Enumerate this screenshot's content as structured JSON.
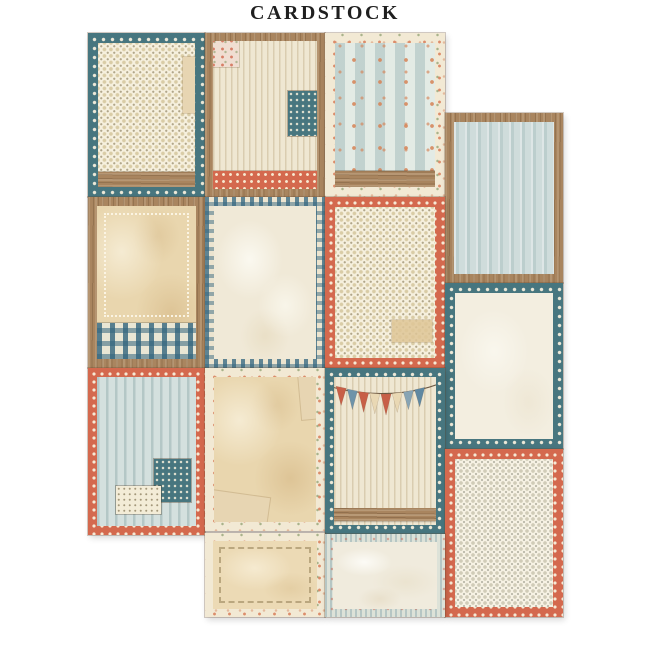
{
  "title": "CARDSTOCK",
  "palette": {
    "background": "#ffffff",
    "title_color": "#1f1f1f",
    "teal": "#47767f",
    "salmon": "#d4694e",
    "cream": "#f3ecd9",
    "tan_paper": "#e8d2a8",
    "wood": "#a9855f",
    "light_blue": "#d4e0de",
    "gingham_blue": "#3e7189"
  },
  "sheet": {
    "description": "Staggered collage of 14 vintage patchwork journaling cards on a cardstock sheet",
    "bunting": {
      "flag_colors": [
        "#c75f47",
        "#6e93a9",
        "#c75f47",
        "#e9d8b4",
        "#c75f47",
        "#e9d8b4",
        "#87a4b4",
        "#5f88a2"
      ],
      "string_color": "#6b5741"
    },
    "cards": [
      {
        "id": "card-1",
        "row": 1,
        "column": 1,
        "border": "teal-polka-dot",
        "center": "cream-micro-dots",
        "accents": [
          "torn-paper-edge",
          "wood-strip-bottom"
        ],
        "label": "Teal polka-dot card with dotted cream center and wood strip"
      },
      {
        "id": "card-2",
        "row": 1,
        "column": 2,
        "border": "wood-frame",
        "center": "cream-ticking-stripes",
        "accents": [
          "floral-patch-top-left",
          "teal-dot-patch-right",
          "coral-polka-strip-bottom"
        ],
        "label": "Wood framed striped card with fabric patches and coral dot band"
      },
      {
        "id": "card-3",
        "row": 1,
        "column": 3,
        "border": "cream-floral",
        "center": "blue-stripes-with-orange-flowers",
        "accents": [
          "wood-strip-bottom"
        ],
        "label": "Floral bordered card with blue striped flower wallpaper and wood strip"
      },
      {
        "id": "card-4",
        "row": 1,
        "column": 4,
        "border": "wood-frame",
        "center": "light-blue-ticking-stripes",
        "accents": [],
        "label": "Wood framed card with light blue ticking stripes"
      },
      {
        "id": "card-5",
        "row": 2,
        "column": 1,
        "border": "wood-frame",
        "center": "aged-parchment",
        "accents": [
          "lace-stitch-inset",
          "blue-gingham-strip-bottom"
        ],
        "label": "Wood framed aged parchment card with lace edge and gingham band"
      },
      {
        "id": "card-6",
        "row": 2,
        "column": 2,
        "border": "blue-gingham",
        "center": "aged-cream-paper",
        "accents": [],
        "label": "Blue gingham bordered card with aged cream paper center"
      },
      {
        "id": "card-7",
        "row": 2,
        "column": 3,
        "border": "coral-polka-dot",
        "center": "cream-micro-dots",
        "accents": [
          "tan-patch-bottom-right"
        ],
        "label": "Coral polka-dot card with dotted cream center and tan patch"
      },
      {
        "id": "card-8",
        "row": 2,
        "column": 4,
        "border": "teal-polka-dot",
        "center": "plain-cream-paper",
        "accents": [],
        "label": "Teal polka-dot card with plain cream center"
      },
      {
        "id": "card-9",
        "row": 3,
        "column": 1,
        "border": "coral-polka-dot",
        "center": "light-blue-ticking-stripes",
        "accents": [
          "teal-dot-patch",
          "cream-dot-patch"
        ],
        "label": "Coral polka-dot card with blue stripes and stitched fabric patches"
      },
      {
        "id": "card-10",
        "row": 3,
        "column": 2,
        "border": "cream-floral",
        "center": "aged-parchment",
        "accents": [
          "torn-paper-corners"
        ],
        "label": "Floral bordered aged parchment card with torn paper corners"
      },
      {
        "id": "card-11",
        "row": 3,
        "column": 3,
        "border": "teal-polka-dot",
        "center": "cream-ticking-stripes",
        "accents": [
          "bunting-banner",
          "wood-plank-bottom"
        ],
        "label": "Teal polka-dot striped card with pennant bunting banner and wood plank"
      },
      {
        "id": "card-12",
        "row": 3,
        "column": 4,
        "border": "coral-polka-dot",
        "center": "cream-micro-dots",
        "accents": [],
        "label": "Coral polka-dot card with dotted cream center"
      },
      {
        "id": "card-13",
        "row": 4,
        "column": 2,
        "border": "cream-floral",
        "center": "light-tan-paper",
        "accents": [
          "stitch-inset"
        ],
        "label": "Floral bordered light tan card with stitched edge (partial)"
      },
      {
        "id": "card-14",
        "row": 4,
        "column": 3,
        "border": "blue-stripe",
        "center": "marbled-cream-paper",
        "accents": [],
        "label": "Blue striped bordered card with marbled cream paper (partial)"
      }
    ]
  }
}
